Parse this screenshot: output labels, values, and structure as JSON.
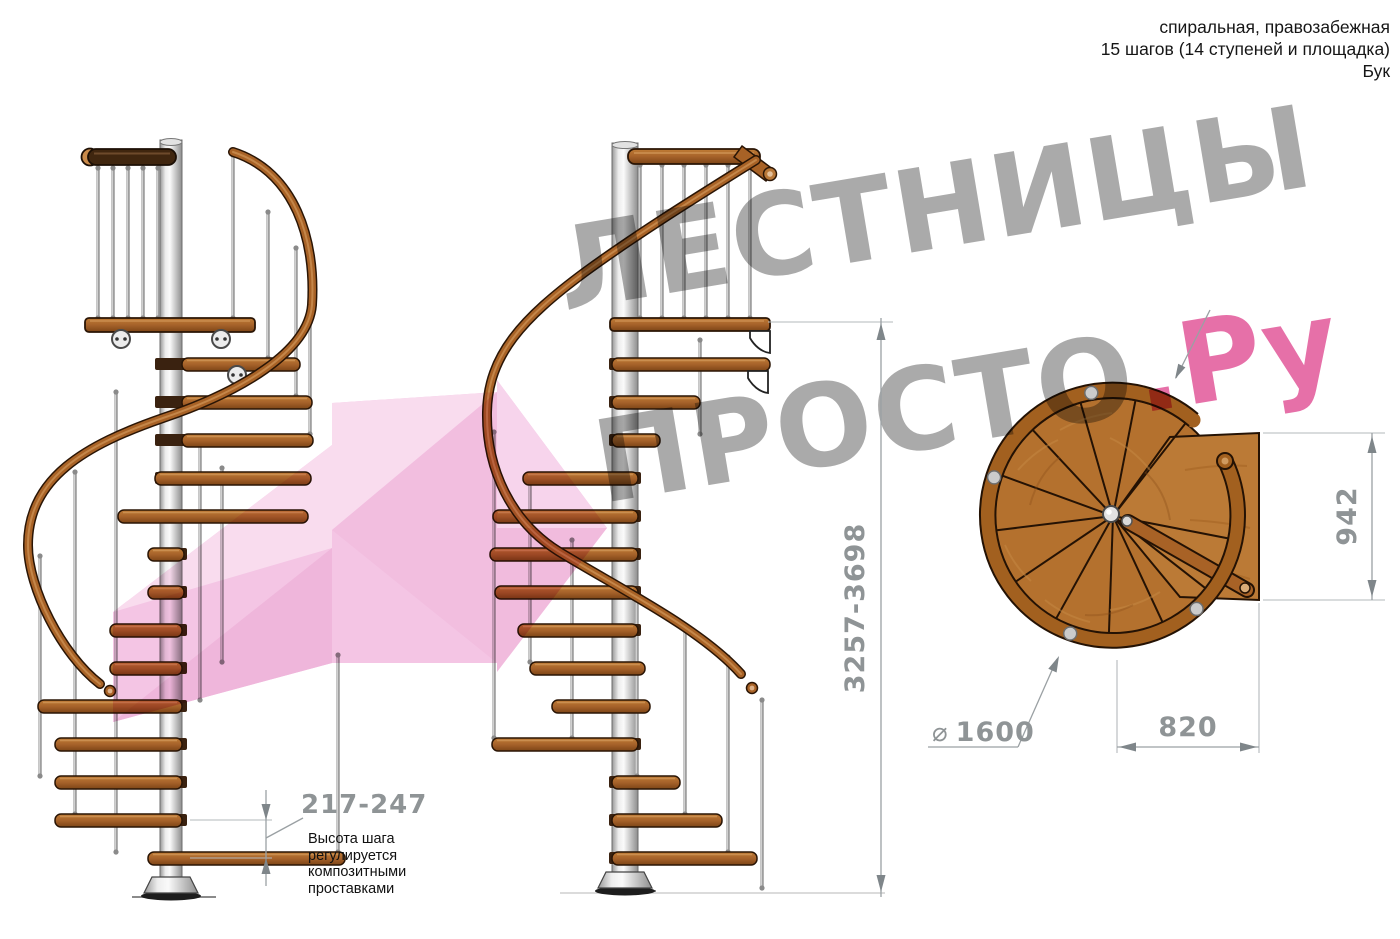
{
  "header": {
    "type_line": "спиральная, правозабежная",
    "steps_line": "15 шагов (14 ступеней и площадка)",
    "material_line": "Бук"
  },
  "watermark": {
    "word_top": "ЛЕСТНИЦЫ",
    "word_bottom": "ПРОСТО",
    "suffix": ".Ру"
  },
  "dimensions": {
    "total_height": "3257-3698",
    "landing_height": "942",
    "landing_width": "820",
    "diameter_symbol": "⌀",
    "diameter_value": "1600",
    "step_height": "217-247",
    "step_height_note": "Высота шага\nрегулируется\nкомпозитными\nпроставками"
  },
  "colors": {
    "wood": "#b4712e",
    "wood_dark": "#8a4d18",
    "wood_rail": "#a86226",
    "wood_outline": "#2a1505",
    "dark_handrail": "#40260f",
    "metal_light": "#f2f2f2",
    "metal": "#c9c9c9",
    "dim_gray": "#8f9496",
    "watermark_gray": "#9c9c9c",
    "watermark_pink": "#e2589a",
    "arrow_pink": "#f2bce0"
  }
}
